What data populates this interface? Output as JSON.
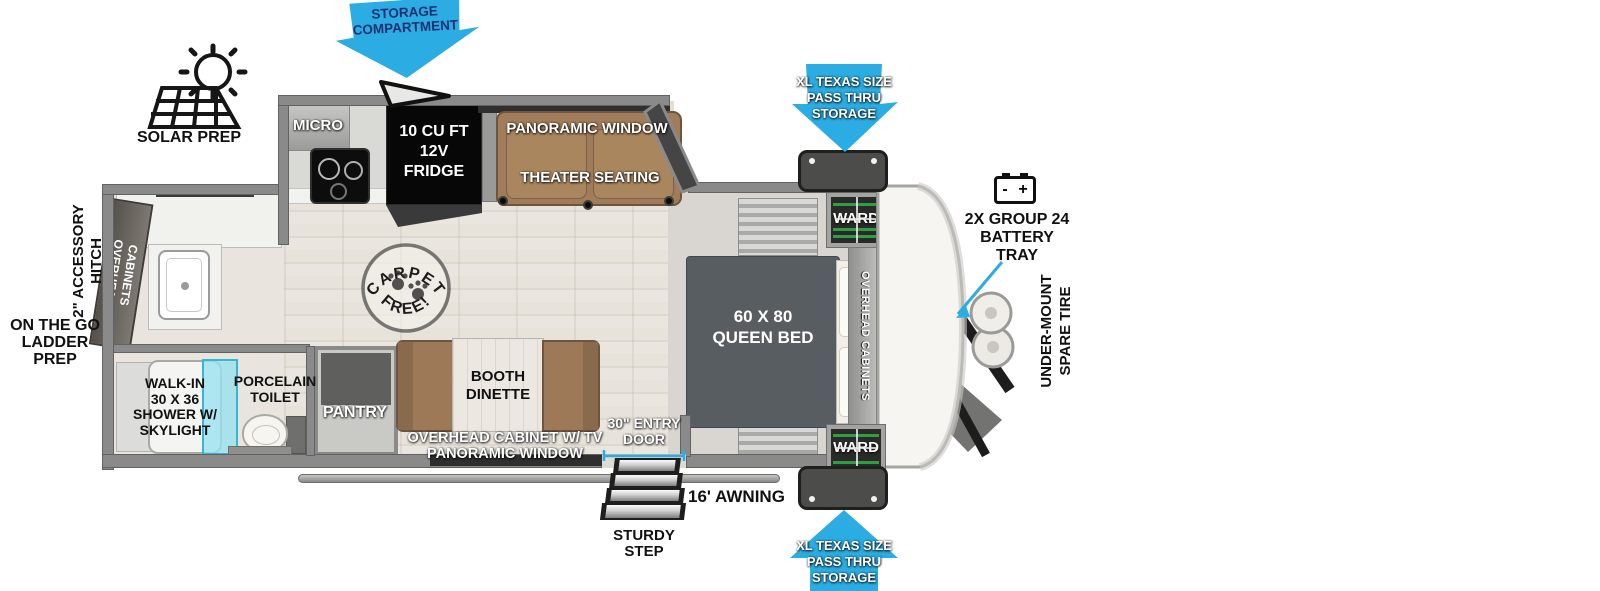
{
  "colors": {
    "callout_blue": "#2BACE2",
    "callout_navy_text": "#1D3076",
    "wall_gray": "#8A8A8A",
    "bed_gray": "#585D62",
    "furniture_brown": "#9F7B59",
    "skylight_cyan": "#A8E4EE",
    "ward_green": "#2F9D43",
    "can_yellow": "#E5D32C"
  },
  "callouts": {
    "storage_compartment": [
      "STORAGE",
      "COMPARTMENT"
    ],
    "pass_thru_top": [
      "XL TEXAS SIZE",
      "PASS THRU",
      "STORAGE"
    ],
    "pass_thru_bottom": [
      "XL TEXAS SIZE",
      "PASS THRU",
      "STORAGE"
    ],
    "solar_prep": "SOLAR PREP",
    "battery_tray": [
      "2X GROUP 24",
      "BATTERY",
      "TRAY"
    ],
    "battery_minus": "-",
    "battery_plus": "+",
    "spare_tire": [
      "UNDER-MOUNT",
      "SPARE TIRE"
    ],
    "accessory_hitch": [
      "2\" ACCESSORY",
      "HITCH"
    ],
    "ladder_prep": [
      "ON THE GO",
      "LADDER PREP"
    ],
    "awning": "16' AWNING",
    "sturdy_step": [
      "STURDY",
      "STEP"
    ],
    "entry_door": [
      "30\" ENTRY",
      "DOOR"
    ]
  },
  "interior": {
    "micro": "MICRO",
    "fridge": [
      "10 CU FT",
      "12V",
      "FRIDGE"
    ],
    "panoramic_window_top": "PANORAMIC WINDOW",
    "theater_seating": "THEATER SEATING",
    "carpet_free": [
      "CARPET",
      "FREE!"
    ],
    "pantry": "PANTRY",
    "booth_dinette": [
      "BOOTH",
      "DINETTE"
    ],
    "overhead_cabinet_tv": [
      "OVERHEAD CABINET W/ TV",
      "PANORAMIC WINDOW"
    ],
    "queen_bed": [
      "60 X 80",
      "QUEEN BED"
    ],
    "ward_top": "WARD",
    "ward_bottom": "WARD",
    "overhead_cabinets_bedroom": "OVERHEAD CABINETS",
    "overhead_cabinets_bath": [
      "OVERHEAD",
      "CABINETS"
    ],
    "shower": [
      "WALK-IN",
      "30 X 36",
      "SHOWER W/",
      "SKYLIGHT"
    ],
    "toilet": [
      "PORCELAIN",
      "TOILET"
    ]
  }
}
